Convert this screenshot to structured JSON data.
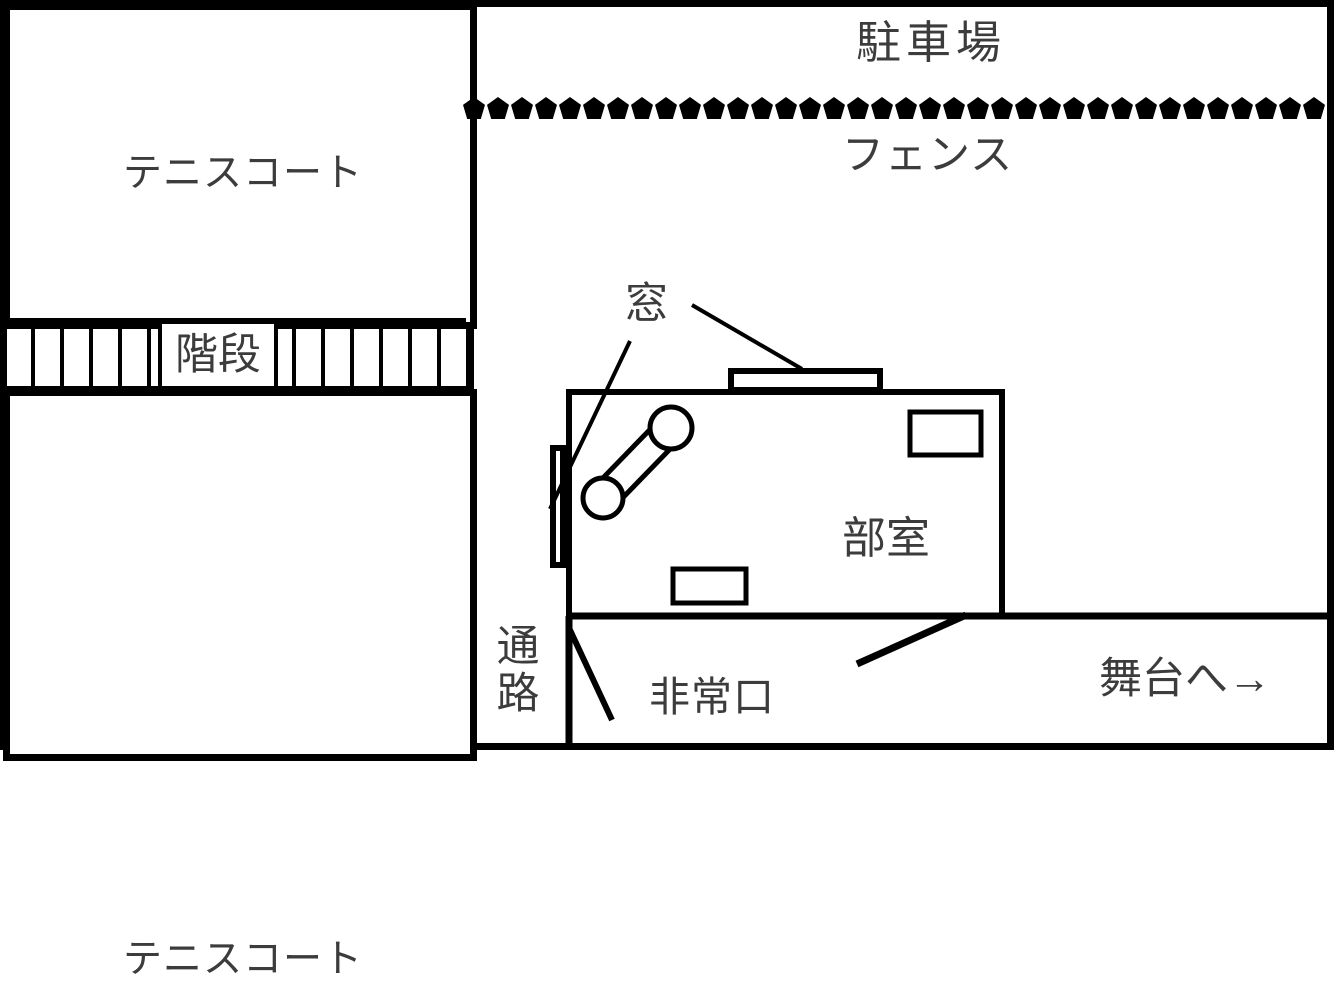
{
  "diagram": {
    "parking_label": "駐車場",
    "fence_label": "フェンス",
    "tennis_top_label": "テニスコート",
    "tennis_bottom_label": "テニスコート",
    "stairs_label": "階段",
    "window_label": "窓",
    "club_room_label": "部室",
    "passage_label": "通路",
    "emergency_exit_label": "非常口",
    "to_stage_label": "舞台へ→"
  },
  "fence": {
    "pentagon_count": 36
  },
  "colors": {
    "line": "#000000",
    "text": "#3c3c3c",
    "background": "#ffffff"
  }
}
